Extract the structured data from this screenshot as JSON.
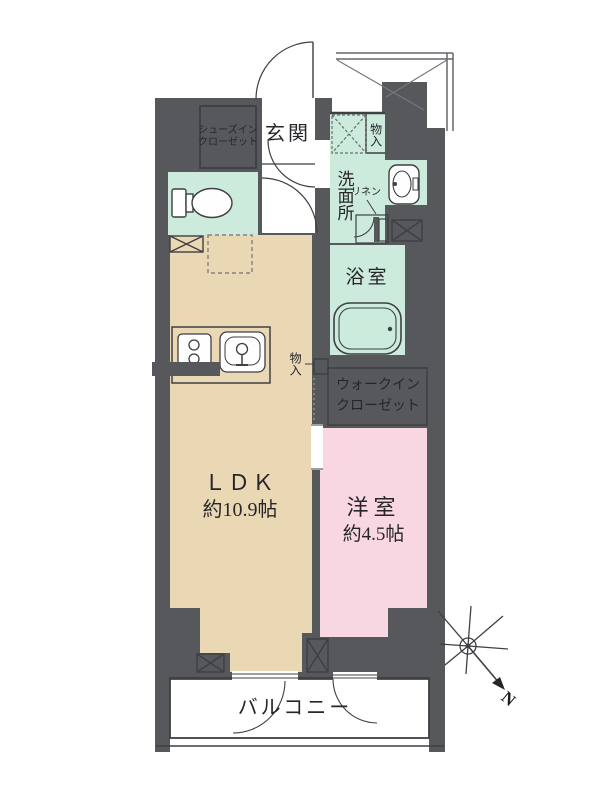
{
  "floorplan": {
    "compass": {
      "label": "N"
    },
    "rooms": {
      "genkan": {
        "label": "玄関"
      },
      "shoes_in_closet": {
        "line1": "シューズイン",
        "line2": "クローゼット"
      },
      "washroom": {
        "label": "洗面所"
      },
      "storage_top": {
        "label": "物入"
      },
      "linen": {
        "label": "リネン"
      },
      "bathroom": {
        "label": "浴室"
      },
      "ldk": {
        "name": "ＬＤＫ",
        "size": "約10.9帖"
      },
      "storage_mid": {
        "label": "物入"
      },
      "walk_in_closet": {
        "line1": "ウォークイン",
        "line2": "クローゼット"
      },
      "western_room": {
        "name": "洋室",
        "size": "約4.5帖"
      },
      "balcony": {
        "label": "バルコニー"
      }
    },
    "colors": {
      "wall": "#57585c",
      "ldk_floor": "#ead8b5",
      "wet_area_floor": "#cdebdc",
      "western_room_floor": "#f9d7e2",
      "line": "#3e3f43",
      "background": "#ffffff"
    }
  }
}
